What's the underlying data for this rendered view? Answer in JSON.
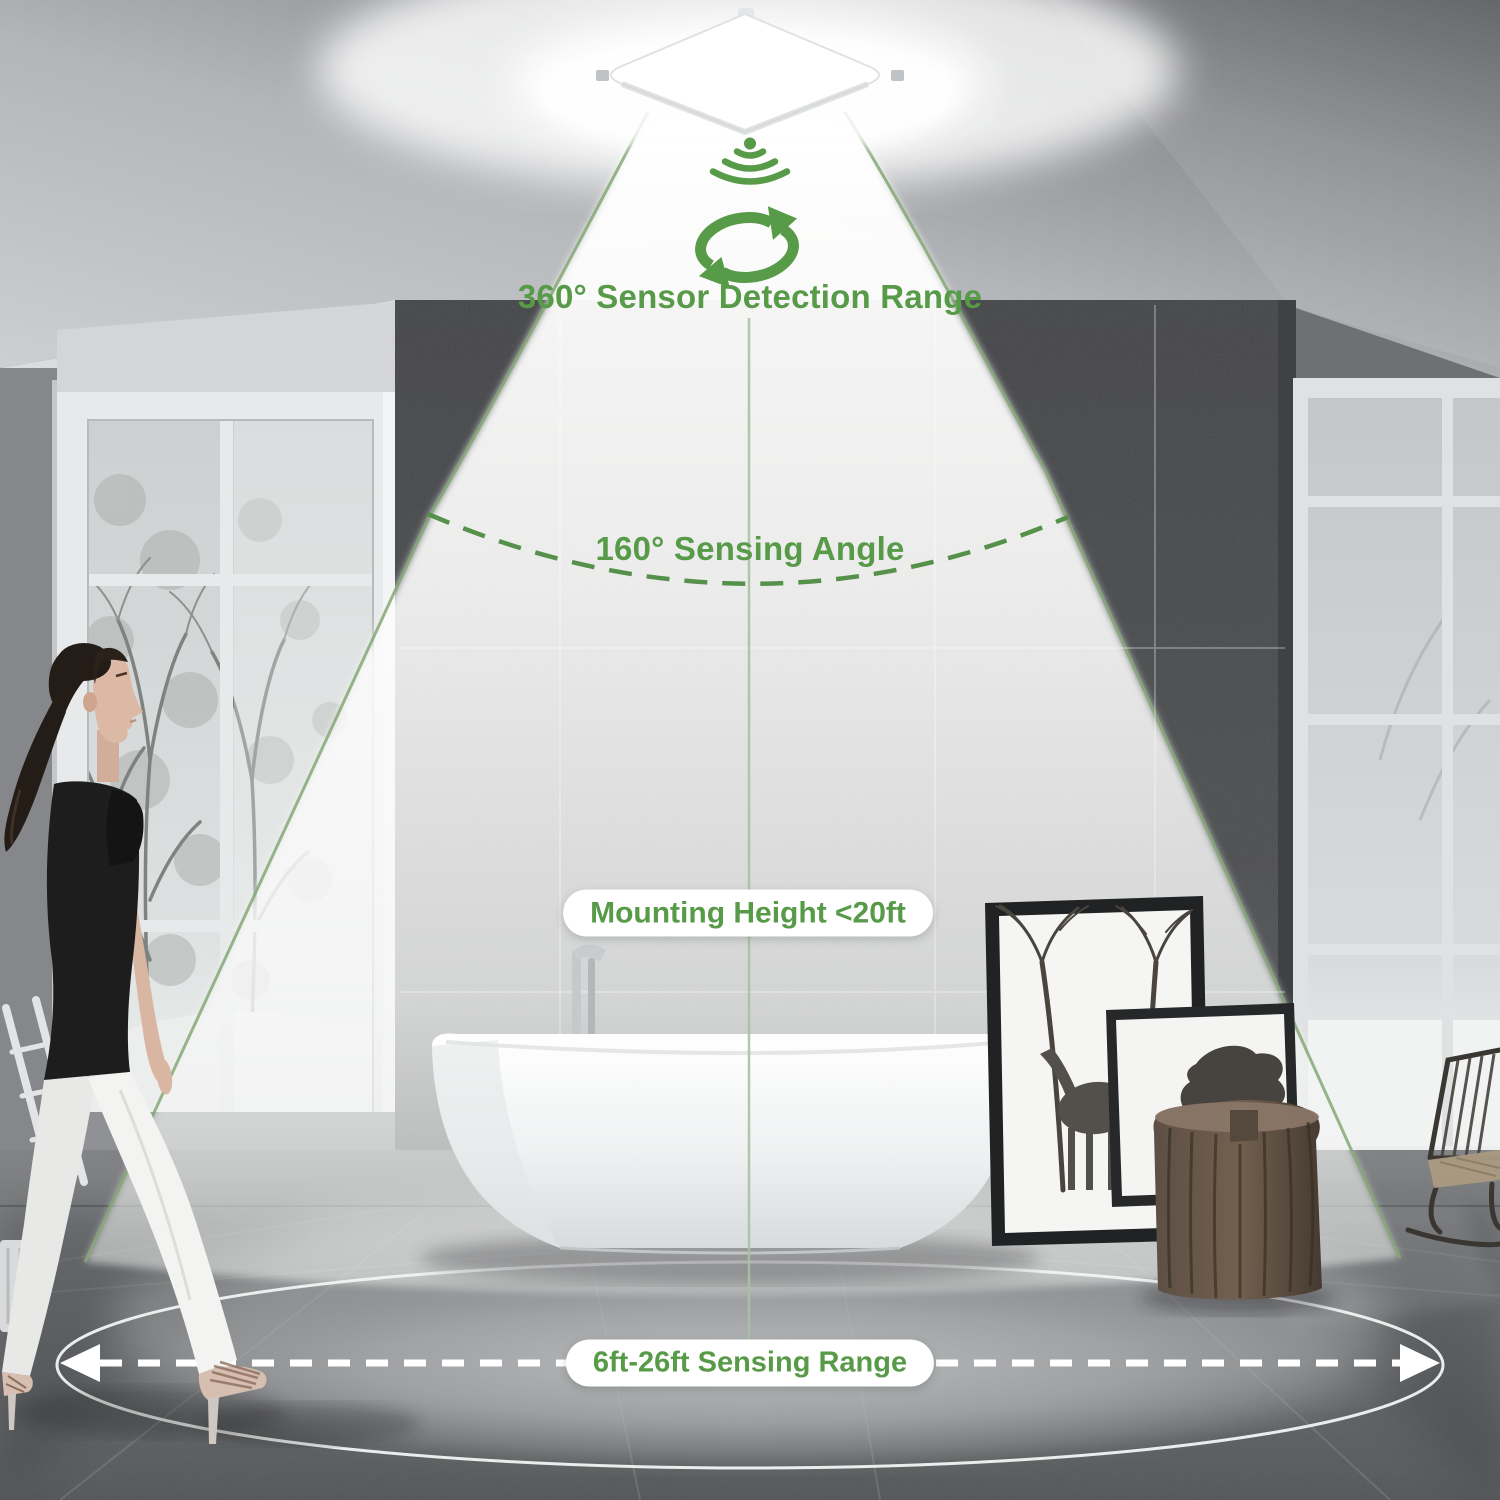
{
  "labels": {
    "detection_range": "360° Sensor Detection Range",
    "sensing_angle": "160° Sensing Angle",
    "mounting_height": "Mounting Height <20ft",
    "sensing_range": "6ft-26ft Sensing Range"
  },
  "icons": {
    "sensor_signal": "downward-radiating-signal-icon",
    "rotation": "circular-rotation-arrows-icon"
  },
  "colors": {
    "annotation_green": "#579a48",
    "beam_edge_green": "#84a876",
    "pill_background": "#ffffff",
    "range_arrow_white": "#ffffff"
  }
}
